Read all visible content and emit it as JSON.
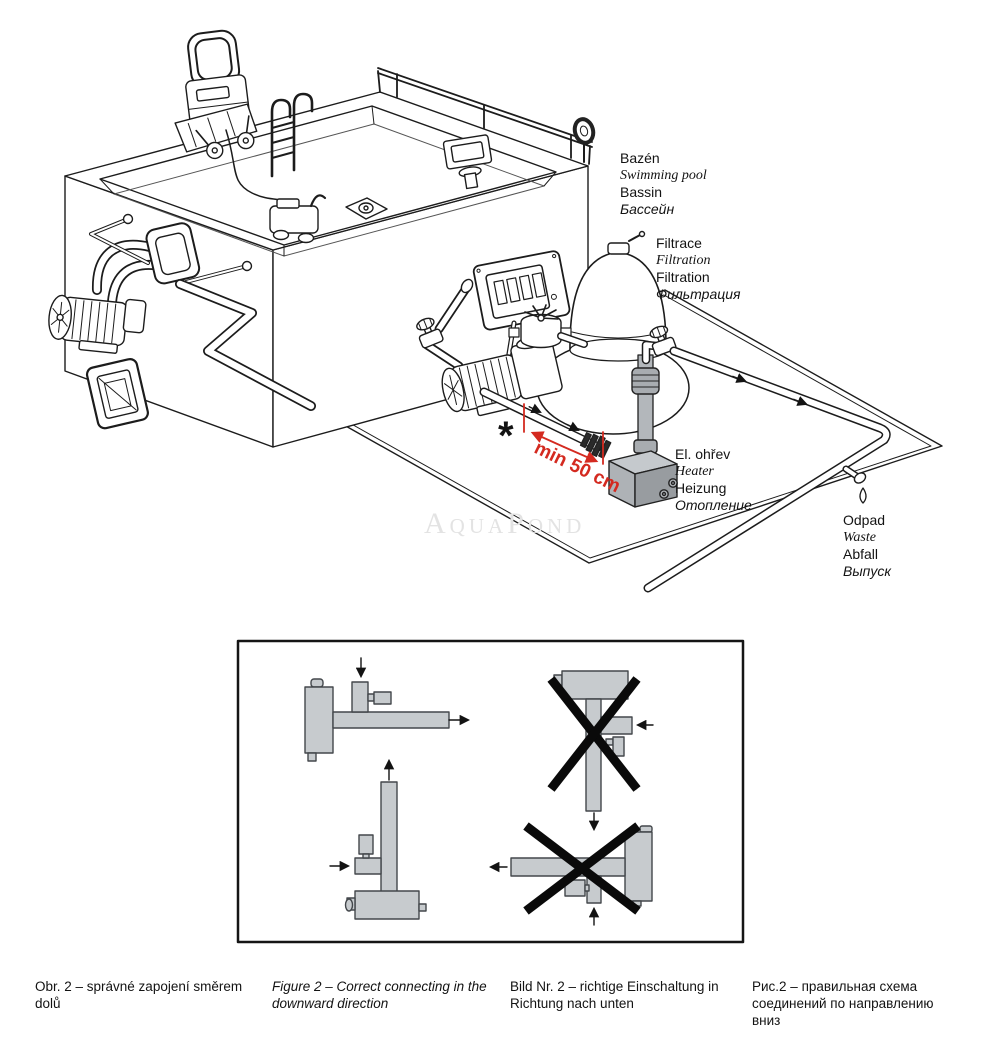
{
  "diagram": {
    "watermark": "AquaPond",
    "labels": {
      "pool": {
        "l1": "Bazén",
        "l2": "Swimming pool",
        "l3": "Bassin",
        "l4": "Бассейн"
      },
      "filtration": {
        "l1": "Filtrace",
        "l2": "Filtration",
        "l3": "Filtration",
        "l4": "Фильтрация"
      },
      "heater": {
        "l1": "El. ohřev",
        "l2": "Heater",
        "l3": "Heizung",
        "l4": "Отопление"
      },
      "waste": {
        "l1": "Odpad",
        "l2": "Waste",
        "l3": "Abfall",
        "l4": "Выпуск"
      }
    },
    "annotation": {
      "asterisk": "*",
      "min_distance": "min 50 cm",
      "color": "#d42a20"
    }
  },
  "figure": {
    "captions": {
      "cs": "Obr. 2 – správné zapojení směrem dolů",
      "en": "Figure 2 – Correct connecting in the downward direction",
      "de": "Bild Nr. 2 – richtige Einschaltung in Richtung nach unten",
      "ru": "Рис.2 – правильная схема соединений по направлению вниз"
    }
  }
}
